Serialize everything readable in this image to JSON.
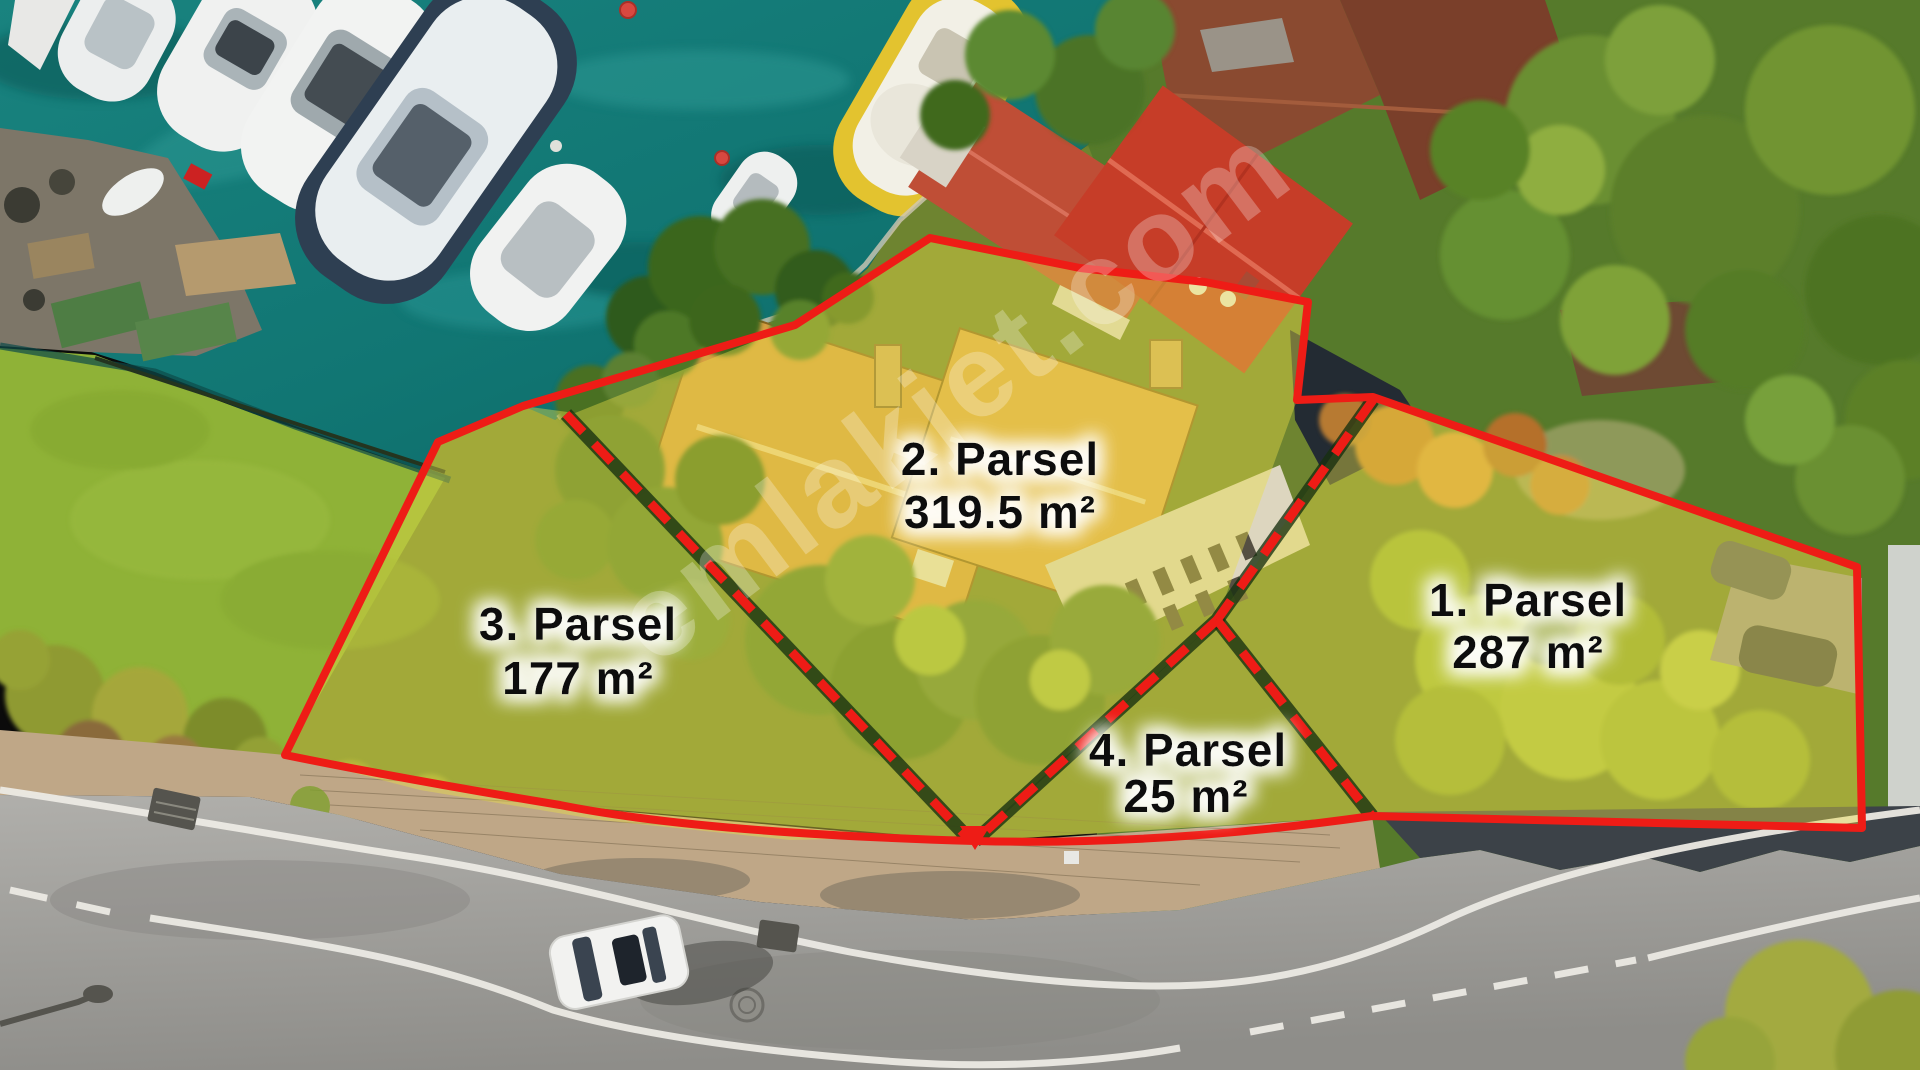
{
  "watermark": {
    "text": "emlakjet.com"
  },
  "annotations": {
    "boundary_color": "#ee1c16",
    "highlight_color": "rgba(233,221,72,0.42)",
    "label_text_color": "#0e0e0e",
    "label_halo_color": "#ffffff",
    "parcels": [
      {
        "id": "1",
        "name_label": "1. Parsel",
        "area_label": "287 m²"
      },
      {
        "id": "2",
        "name_label": "2. Parsel",
        "area_label": "319.5 m²"
      },
      {
        "id": "3",
        "name_label": "3. Parsel",
        "area_label": "177 m²"
      },
      {
        "id": "4",
        "name_label": "4. Parsel",
        "area_label": "25 m²"
      }
    ]
  },
  "scene": {
    "water_color": "#137a77",
    "lawn_color": "#8fb237",
    "road_color": "#9b9a96",
    "sidewalk_color": "#bfa787",
    "mansion_roof_color": "#d89f42",
    "red_roof_color": "#c63d28"
  }
}
